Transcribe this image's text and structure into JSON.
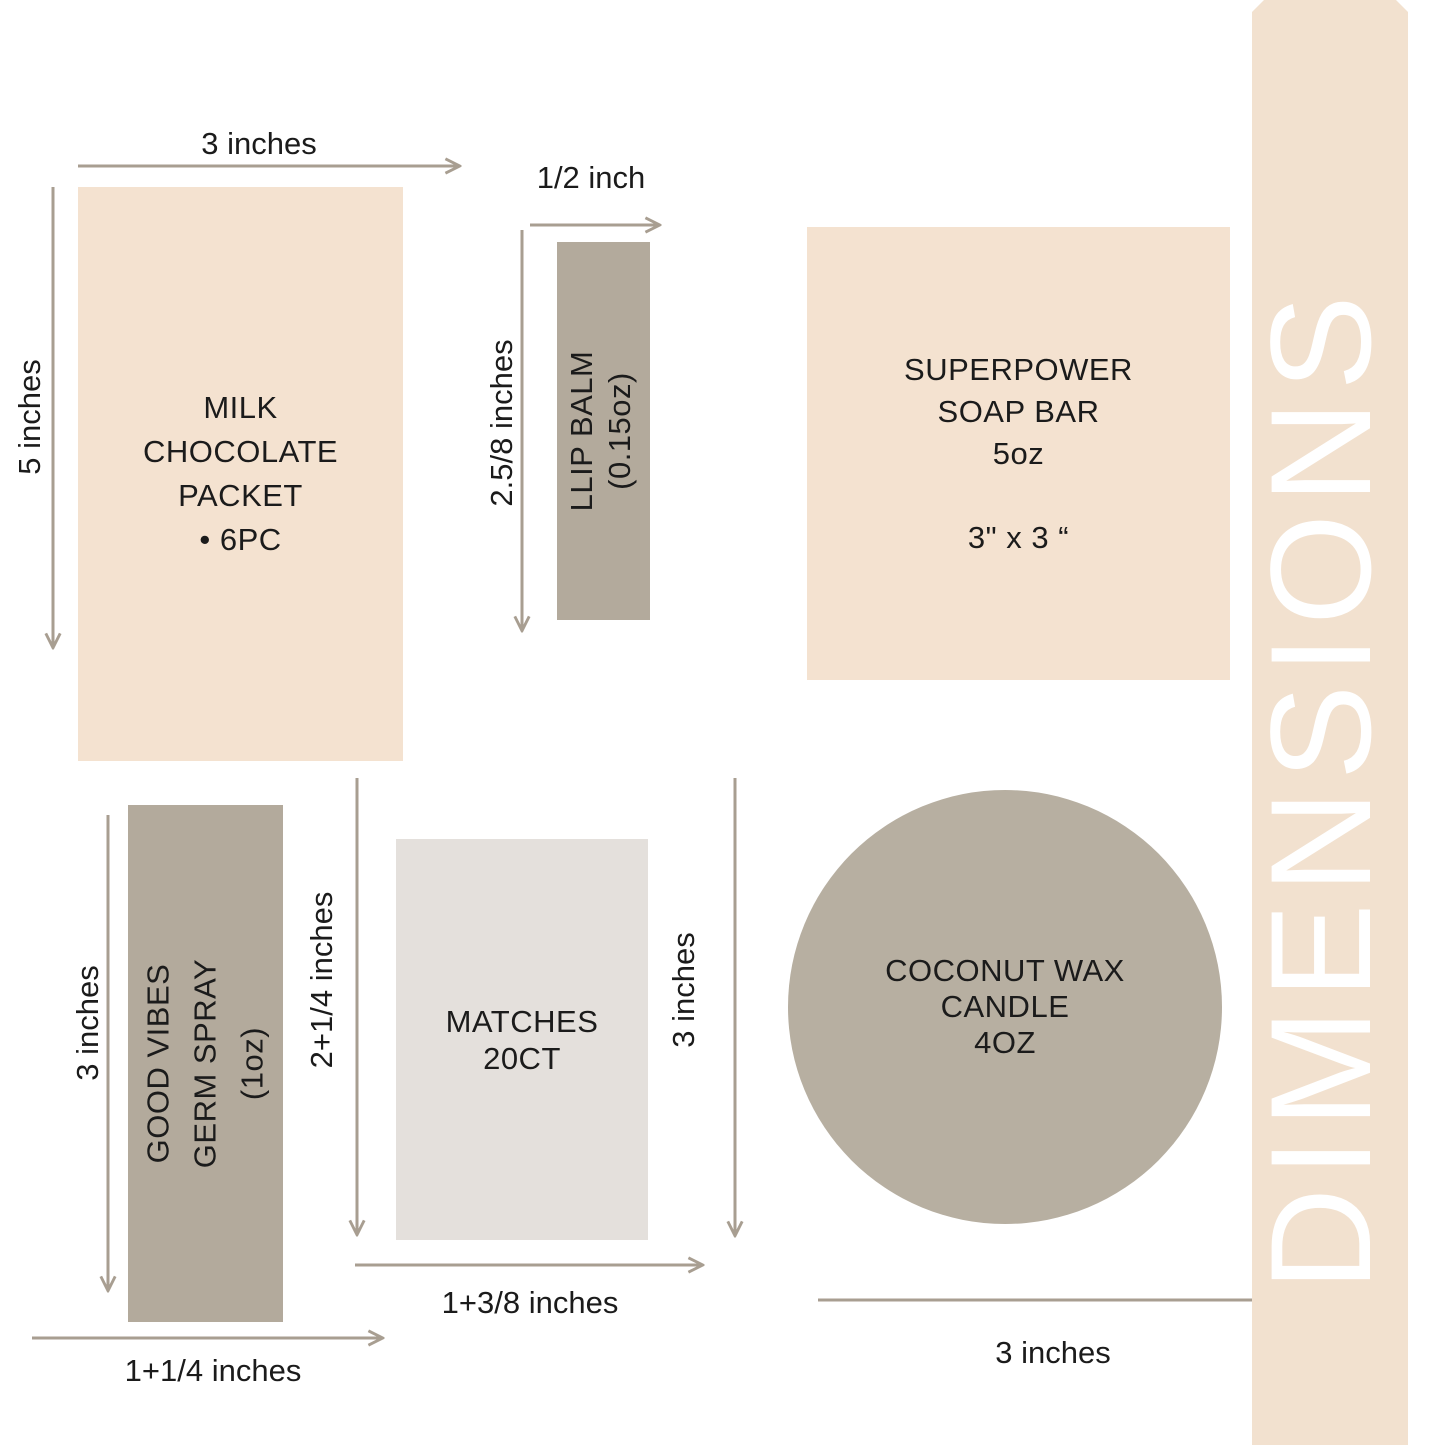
{
  "band": {
    "title": "DIMENSIONS"
  },
  "products": {
    "chocolate": {
      "lines": [
        "MILK",
        "CHOCOLATE",
        "PACKET",
        "• 6PC"
      ],
      "width_label": "3 inches",
      "height_label": "5 inches"
    },
    "lip_balm": {
      "lines": [
        "LLIP BALM",
        "(0.15oz)"
      ],
      "width_label": "1/2 inch",
      "height_label": "2.5/8 inches"
    },
    "soap": {
      "lines": [
        "SUPERPOWER",
        "SOAP BAR",
        "5oz"
      ],
      "size_label": "3\" x 3 “"
    },
    "germ_spray": {
      "lines": [
        "GOOD VIBES",
        "GERM SPRAY",
        "(1oz)"
      ],
      "height_label": "3 inches",
      "width_label": "1+1/4 inches"
    },
    "matches": {
      "lines": [
        "MATCHES",
        "20CT"
      ],
      "height_left_label": "2+1/4 inches",
      "height_right_label": "3 inches",
      "width_label": "1+3/8 inches"
    },
    "candle": {
      "lines": [
        "COCONUT WAX",
        "CANDLE",
        "4OZ"
      ],
      "width_label": "3 inches"
    }
  },
  "colors": {
    "background": "#ffffff",
    "cream": "#f4e2d0",
    "band_cream": "#f2e1cf",
    "taupe": "#b3aa9c",
    "candle_taupe": "#b7afa1",
    "matches_gray": "#e4e0dc",
    "arrow": "#a89e91",
    "text": "#1b1b1b",
    "band_text": "#ffffff"
  }
}
